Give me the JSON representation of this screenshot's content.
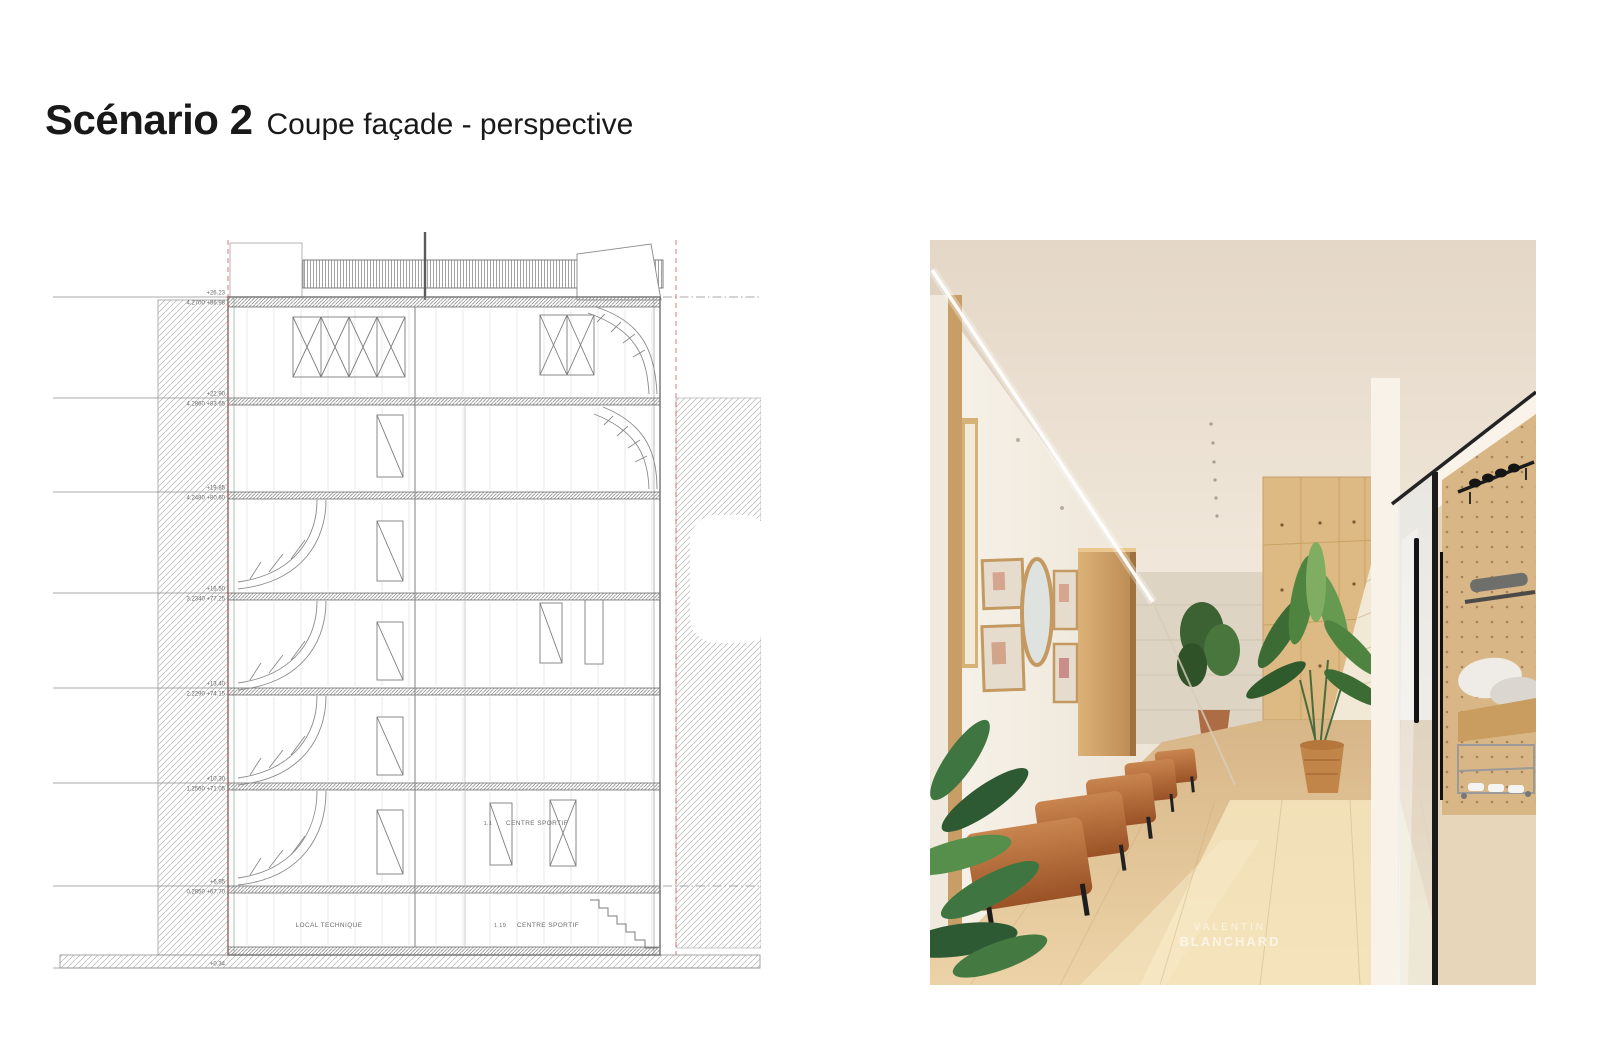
{
  "slide": {
    "title": "Scénario 2",
    "subtitle": "Coupe façade - perspective",
    "background": "#ffffff"
  },
  "section": {
    "colors": {
      "line": "#8c8c8c",
      "dark": "#666666",
      "light": "#c9c9c9",
      "red_dashed": "#d05050",
      "hatch": "#a8a8a8",
      "label": "#6a6a6a"
    },
    "levels": [
      {
        "elev": "+26.23",
        "note": "4.2700  +86.98"
      },
      {
        "elev": "+22.90",
        "note": "4.2860  +83.65"
      },
      {
        "elev": "+19.85",
        "note": "4.2480  +80.60"
      },
      {
        "elev": "+16.50",
        "note": "3.2340  +77.25"
      },
      {
        "elev": "+13.40",
        "note": "2.2290  +74.15"
      },
      {
        "elev": "+10.30",
        "note": "1.2560  +71.05"
      },
      {
        "elev": "+6.95",
        "note": "0.2850  +67.70"
      },
      {
        "elev": "+0.34",
        "note": "-1.750  +61.09"
      }
    ],
    "rooms": {
      "upper_prefix": "1.1",
      "upper": "CENTRE SPORTIF",
      "lower_left": "LOCAL TECHNIQUE",
      "lower_right_prefix": "1.19",
      "lower_right": "CENTRE SPORTIF"
    }
  },
  "photo": {
    "watermark": {
      "line1": "VALENTIN",
      "line2": "BLANCHARD"
    },
    "colors": {
      "ceiling": "#e7dbcc",
      "wall": "#f5f0e7",
      "wood": "#d0a76e",
      "floor": "#e5c79c",
      "leather": "#b06a38",
      "plant": "#4e7d3e",
      "glass_frame": "#1f1f1f",
      "travertine": "#ded4c3"
    }
  }
}
